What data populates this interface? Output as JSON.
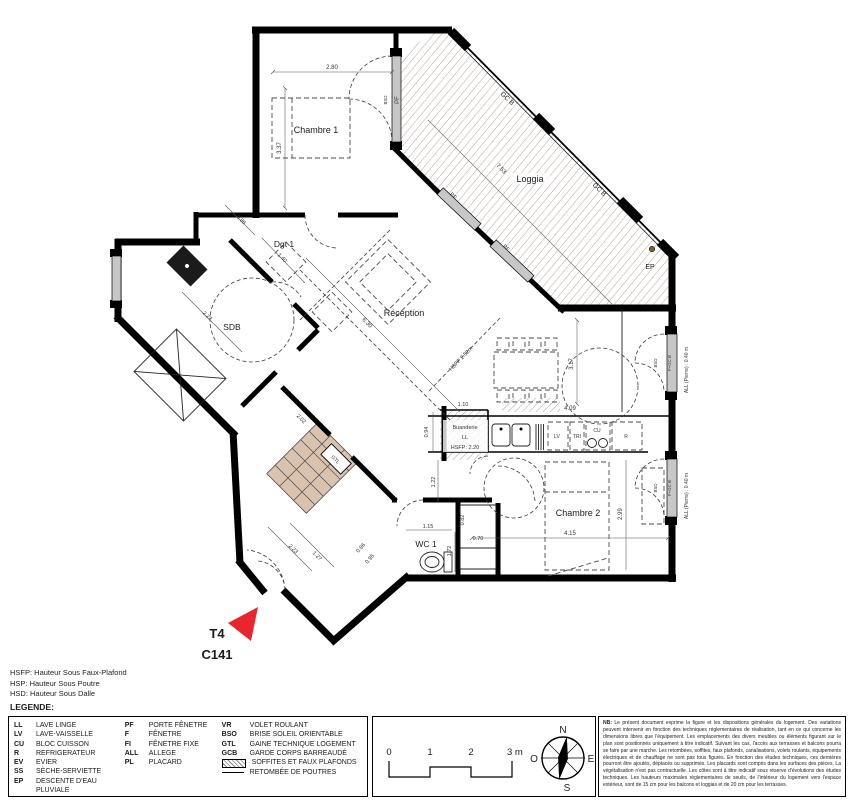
{
  "plan": {
    "marker": {
      "type_label": "T4",
      "unit": "C141"
    },
    "rooms": {
      "chambre1": "Chambre 1",
      "loggia": "Loggia",
      "dgt1": "Dgt 1",
      "sdb": "SDB",
      "reception": "Réception",
      "buanderie": "Buanderie",
      "chambre2": "Chambre 2",
      "wc1": "WC 1"
    },
    "annotations": {
      "pf": "PF",
      "gcb": "GC B",
      "ep": "EP",
      "ll": "LL",
      "hsfp_buanderie": "HSFP: 2.20",
      "lv": "LV",
      "tri": "TRI",
      "cu": "CU",
      "r": "R",
      "bso": "BSO",
      "f_gcb": "F+GC B",
      "all_pierre": "ALL (Pierre) : 0.40 m",
      "gtl": "GTL",
      "hsfp_reception": "HSFP 2.52m"
    },
    "dims": {
      "chambre1_w": "2.80",
      "chambre1_h": "3.37",
      "loggia_l": "7.53",
      "dgt_a": "0.86",
      "dgt_b": "1.40",
      "sdb_l": "2.27",
      "reception_l": "6.30",
      "sejour_h": "3.17",
      "kitchen_w": "4.09",
      "buanderie_w": "1.10",
      "buanderie_h": "0.94",
      "hall_h": "1.22",
      "chambre2_w": "4.15",
      "chambre2_h": "2.99",
      "wc_w": "1.15",
      "wc_h": "1.72",
      "niche_h": "0.82",
      "niche_w": "0.70",
      "entry_a": "2.02",
      "entry_b": "2.23",
      "entry_c": "1.27",
      "entry_d": "0.86",
      "entry_e": "0.95"
    }
  },
  "footnotes": {
    "l1": "HSFP: Hauteur Sous Faux-Plafond",
    "l2": "HSP: Hauteur Sous Poutre",
    "l3": "HSD: Hauteur Sous Dalle"
  },
  "legend": {
    "title": "LEGENDE:",
    "col1": [
      {
        "abbr": "LL",
        "label": "LAVE LINGE"
      },
      {
        "abbr": "LV",
        "label": "LAVE-VAISSELLE"
      },
      {
        "abbr": "CU",
        "label": "BLOC CUISSON"
      },
      {
        "abbr": "R",
        "label": "REFRIGERATEUR"
      },
      {
        "abbr": "EV",
        "label": "EVIER"
      },
      {
        "abbr": "SS",
        "label": "SÈCHE-SERVIETTE"
      },
      {
        "abbr": "EP",
        "label": "DESCENTE D'EAU PLUVIALE"
      }
    ],
    "col2": [
      {
        "abbr": "PF",
        "label": "PORTE FÊNETRE"
      },
      {
        "abbr": "F",
        "label": "FÊNETRE"
      },
      {
        "abbr": "FI",
        "label": "FÊNETRE FIXE"
      },
      {
        "abbr": "ALL",
        "label": "ALLEGE"
      },
      {
        "abbr": "PL",
        "label": "PLACARD"
      }
    ],
    "col3": [
      {
        "abbr": "VR",
        "label": "VOLET ROULANT"
      },
      {
        "abbr": "BSO",
        "label": "BRISE SOLEIL ORIENTABLE"
      },
      {
        "abbr": "GTL",
        "label": "GAINE TECHNIQUE LOGEMENT"
      },
      {
        "abbr": "GCB",
        "label": "GARDE CORPS BARREAUDÉ"
      },
      {
        "swatch": "hatch",
        "label": "SOFFITES ET FAUX PLAFONDS"
      },
      {
        "swatch": "line",
        "label": "RETOMBÉE DE POUTRES"
      }
    ]
  },
  "scalebar": {
    "t0": "0",
    "t1": "1",
    "t2": "2",
    "t3": "3 m"
  },
  "compass": {
    "n": "N",
    "s": "S",
    "e": "E",
    "o": "O"
  },
  "nb": {
    "label": "NB:",
    "text": "Le présent document exprime la figure et les dispositions générales du logement. Des variations peuvent intervenir en fonction des techniques réglementaires de réalisation, tant en ce qui concerne les dimensions libres que l'équipement. Les emplacements des divers meubles ou éléments figurant sur le plan sont positionnés uniquement à titre indicatif. Suivant les cas, l'accès aux terrasses et balcons pourra se faire par une marche. Les retombées, soffites, faux plafonds, canalisations, volets roulants, équipements électriques et de chauffage ne sont pas tous figurés. En fonction des études techniques, ces dernières pourront être ajoutés, déplacés ou supprimés. Les placards sont compris dans les surfaces des pièces. La végétalisation n'est pas contractuelle. Les côtes sont à titre indicatif sous réserve d'évolutions des études techniques. Les hauteurs maximales réglementaires de seuils, de l'intérieur du logement vers l'espace extérieur, sont de 15 cm pour les balcons et loggias et de 20 cm pour les terrasses."
  }
}
